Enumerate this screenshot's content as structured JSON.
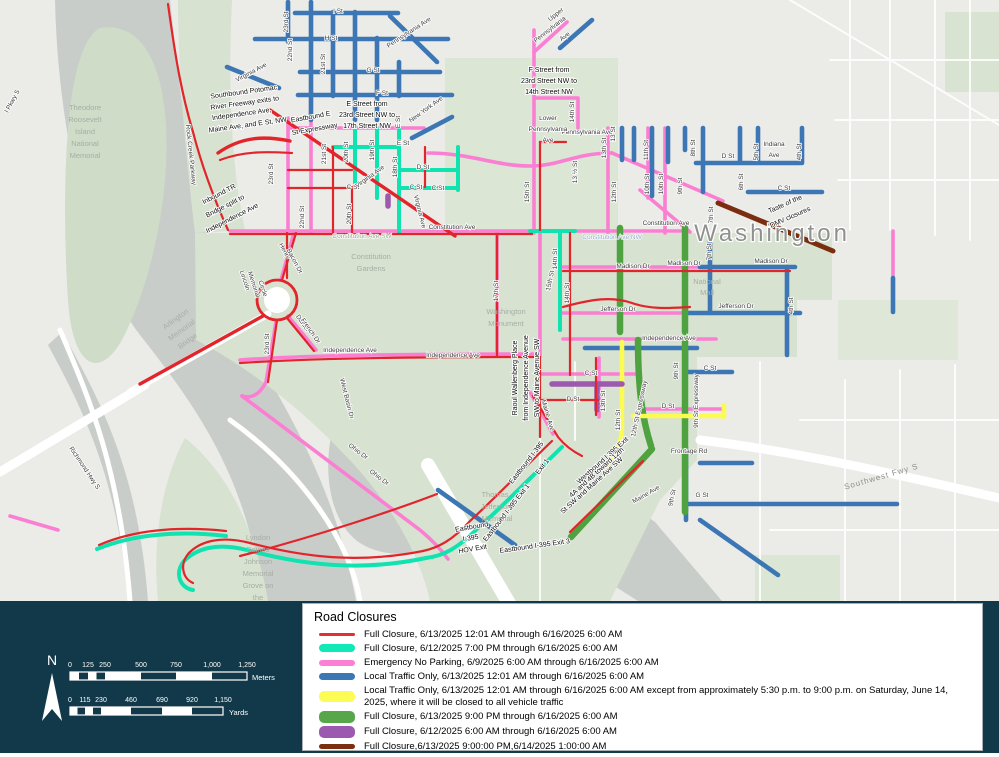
{
  "legend": {
    "title": "Road Closures",
    "items": [
      {
        "color": "#e03131",
        "label": "Full Closure, 6/13/2025 12:01 AM through 6/16/2025 6:00 AM"
      },
      {
        "color": "#0fe9b8",
        "label": "Full Closure, 6/12/2025 7:00 PM through 6/16/2025 6:00 AM"
      },
      {
        "color": "#fb7fd4",
        "label": "Emergency No Parking, 6/9/2025 6:00 AM through 6/16/2025 6:00 AM"
      },
      {
        "color": "#3b76b5",
        "label": "Local Traffic Only, 6/13/2025 12:01 AM through 6/16/2025 6:00 AM"
      },
      {
        "color": "#fcfc54",
        "label": "Local Traffic Only, 6/13/2025 12:01 AM through 6/16/2025 6:00 AM except from approximately 5:30 p.m. to 9:00 p.m. on Saturday, June 14, 2025, where it will be closed to all vehicle traffic"
      },
      {
        "color": "#57a649",
        "label": "Full Closure, 6/13/2025 9:00 PM through 6/16/2025 6:00 AM"
      },
      {
        "color": "#9c59b0",
        "label": "Full Closure, 6/12/2025 6:00 AM through 6/16/2025 6:00 AM"
      },
      {
        "color": "#7c2f10",
        "label": "Full Closure,6/13/2025 9:00:00 PM,6/14/2025 1:00:00 AM"
      }
    ]
  },
  "scale": {
    "north": "N",
    "meters": {
      "ticks": [
        "0",
        "125",
        "250",
        "500",
        "750",
        "1,000",
        "1,250"
      ],
      "unit": "Meters"
    },
    "yards": {
      "ticks": [
        "0",
        "115",
        "230",
        "460",
        "690",
        "920",
        "1,150"
      ],
      "unit": "Yards"
    }
  },
  "colors": {
    "panel_bg": "#113949",
    "map_land": "#ebebe7",
    "water": "#c9cdc9",
    "park": "#d7e2d0",
    "full_closure_red": "#e03131",
    "full_closure_cyan": "#0fe9b8",
    "emergency_pink": "#fb7fd4",
    "local_traffic_blue": "#3b76b5",
    "local_traffic_yellow": "#fcfc54",
    "full_closure_green": "#57a649",
    "full_closure_purple": "#9c59b0",
    "full_closure_brown": "#7c2f10"
  },
  "map": {
    "labels": [
      {
        "t": "I St"
      },
      {
        "t": "H St"
      },
      {
        "t": "G St"
      },
      {
        "t": "F St"
      },
      {
        "t": "Pennsylvania Ave"
      },
      {
        "t": "23rd St"
      },
      {
        "t": "22nd St"
      },
      {
        "t": "21st St"
      },
      {
        "t": "Virginia Ave"
      },
      {
        "t": "Southbound Potomac"
      },
      {
        "t": "River Freeway exits to"
      },
      {
        "t": "Independence Ave,"
      },
      {
        "t": "Maine Ave, and E St, NW"
      },
      {
        "t": "Rock Creek Parkway"
      },
      {
        "t": "Theodore"
      },
      {
        "t": "Roosevelt"
      },
      {
        "t": "Island"
      },
      {
        "t": "National"
      },
      {
        "t": "Memorial"
      },
      {
        "t": "l Pkwy S"
      },
      {
        "t": "Inbound TR"
      },
      {
        "t": "Bridge split to"
      },
      {
        "t": "Independence Ave"
      },
      {
        "t": "Eastbound E"
      },
      {
        "t": "St Expressway"
      },
      {
        "t": "E Street from"
      },
      {
        "t": "23rd Street NW to"
      },
      {
        "t": "17th Street NW"
      },
      {
        "t": "New York Ave"
      },
      {
        "t": "E St"
      },
      {
        "t": "E St"
      },
      {
        "t": "D St"
      },
      {
        "t": "C St"
      },
      {
        "t": "C St"
      },
      {
        "t": "C St"
      },
      {
        "t": "Virginia Ave"
      },
      {
        "t": "Virginia Ave"
      },
      {
        "t": "23rd St"
      },
      {
        "t": "22nd St"
      },
      {
        "t": "21st St"
      },
      {
        "t": "20th St"
      },
      {
        "t": "20th St"
      },
      {
        "t": "19th St"
      },
      {
        "t": "18th St"
      },
      {
        "t": "Pennsylvania Ave"
      },
      {
        "t": "Upper"
      },
      {
        "t": "Pennsylvania"
      },
      {
        "t": "Ave"
      },
      {
        "t": "F Street from"
      },
      {
        "t": "23rd Street NW to"
      },
      {
        "t": "14th Street NW"
      },
      {
        "t": "Lower"
      },
      {
        "t": "Pennsylvania"
      },
      {
        "t": "Ave"
      },
      {
        "t": "14th St"
      },
      {
        "t": "13 ½ St"
      },
      {
        "t": "15th St"
      },
      {
        "t": "13th St"
      },
      {
        "t": "13 St"
      },
      {
        "t": "12th St"
      },
      {
        "t": "11th St"
      },
      {
        "t": "10th St"
      },
      {
        "t": "10th St"
      },
      {
        "t": "9th St"
      },
      {
        "t": "8th St"
      },
      {
        "t": "D St"
      },
      {
        "t": "Indiana"
      },
      {
        "t": "Ave"
      },
      {
        "t": "5th St"
      },
      {
        "t": "4th St"
      },
      {
        "t": "6th St"
      },
      {
        "t": "C St"
      },
      {
        "t": "Constitution Ave"
      },
      {
        "t": "Constitution Ave SW"
      },
      {
        "t": "Constitution Ave NW"
      },
      {
        "t": "Constitution Ave"
      },
      {
        "t": "Washington"
      },
      {
        "t": "Taste of the"
      },
      {
        "t": "DMV closures"
      },
      {
        "t": "Madison Dr"
      },
      {
        "t": "Madison Dr"
      },
      {
        "t": "Madison Dr"
      },
      {
        "t": "National"
      },
      {
        "t": "Mall"
      },
      {
        "t": "Jefferson Dr"
      },
      {
        "t": "Jefferson Dr"
      },
      {
        "t": "4th St"
      },
      {
        "t": "Constitution"
      },
      {
        "t": "Gardens"
      },
      {
        "t": "17th St"
      },
      {
        "t": "Washington"
      },
      {
        "t": "Monument"
      },
      {
        "t": "15th St"
      },
      {
        "t": "14th St"
      },
      {
        "t": "14th St"
      },
      {
        "t": "Henry"
      },
      {
        "t": "Bacon Dr"
      },
      {
        "t": "Lincoln"
      },
      {
        "t": "Memorial"
      },
      {
        "t": "Circle"
      },
      {
        "t": "Daniel"
      },
      {
        "t": "French Dr"
      },
      {
        "t": "23rd St"
      },
      {
        "t": "Arlington"
      },
      {
        "t": "Memorial"
      },
      {
        "t": "Bridge"
      },
      {
        "t": "Independence Ave"
      },
      {
        "t": "Independence Ave"
      },
      {
        "t": "Independence Ave"
      },
      {
        "t": "West Basin Dr"
      },
      {
        "t": "Ohio Dr"
      },
      {
        "t": "Ohio Dr"
      },
      {
        "t": "Richmond Hwy S"
      },
      {
        "t": "Lyndon"
      },
      {
        "t": "Baines"
      },
      {
        "t": "Johnson"
      },
      {
        "t": "Memorial"
      },
      {
        "t": "Grove on"
      },
      {
        "t": "the"
      },
      {
        "t": "Raoul Wallenberg Place"
      },
      {
        "t": "from Independence Avenue"
      },
      {
        "t": "SW to Maine Avenue SW"
      },
      {
        "t": "Maine"
      },
      {
        "t": "Ave"
      },
      {
        "t": "C St"
      },
      {
        "t": "D St"
      },
      {
        "t": "13th St"
      },
      {
        "t": "12th St"
      },
      {
        "t": "12th St Expressway"
      },
      {
        "t": "9th St"
      },
      {
        "t": "9th St Expressway"
      },
      {
        "t": "C St"
      },
      {
        "t": "D St"
      },
      {
        "t": "Frontage Rd"
      },
      {
        "t": "G St"
      },
      {
        "t": "9th St"
      },
      {
        "t": "Maine Ave"
      },
      {
        "t": "Westbound I 395 Exit"
      },
      {
        "t": "4A and 4B toward 12th"
      },
      {
        "t": "St SW and Maine Ave SW"
      },
      {
        "t": "Eastbound I-395"
      },
      {
        "t": "Exit 1"
      },
      {
        "t": "Eastbound I-395 Exit 1"
      },
      {
        "t": "Eastbound"
      },
      {
        "t": "I-395"
      },
      {
        "t": "HOV Exit"
      },
      {
        "t": "Eastbound I-395 Exit 3"
      },
      {
        "t": "Thomas"
      },
      {
        "t": "Jefferson"
      },
      {
        "t": "Memorial"
      },
      {
        "t": "Southwest Fwy S"
      },
      {
        "t": "7th St"
      },
      {
        "t": "7th St"
      }
    ]
  }
}
